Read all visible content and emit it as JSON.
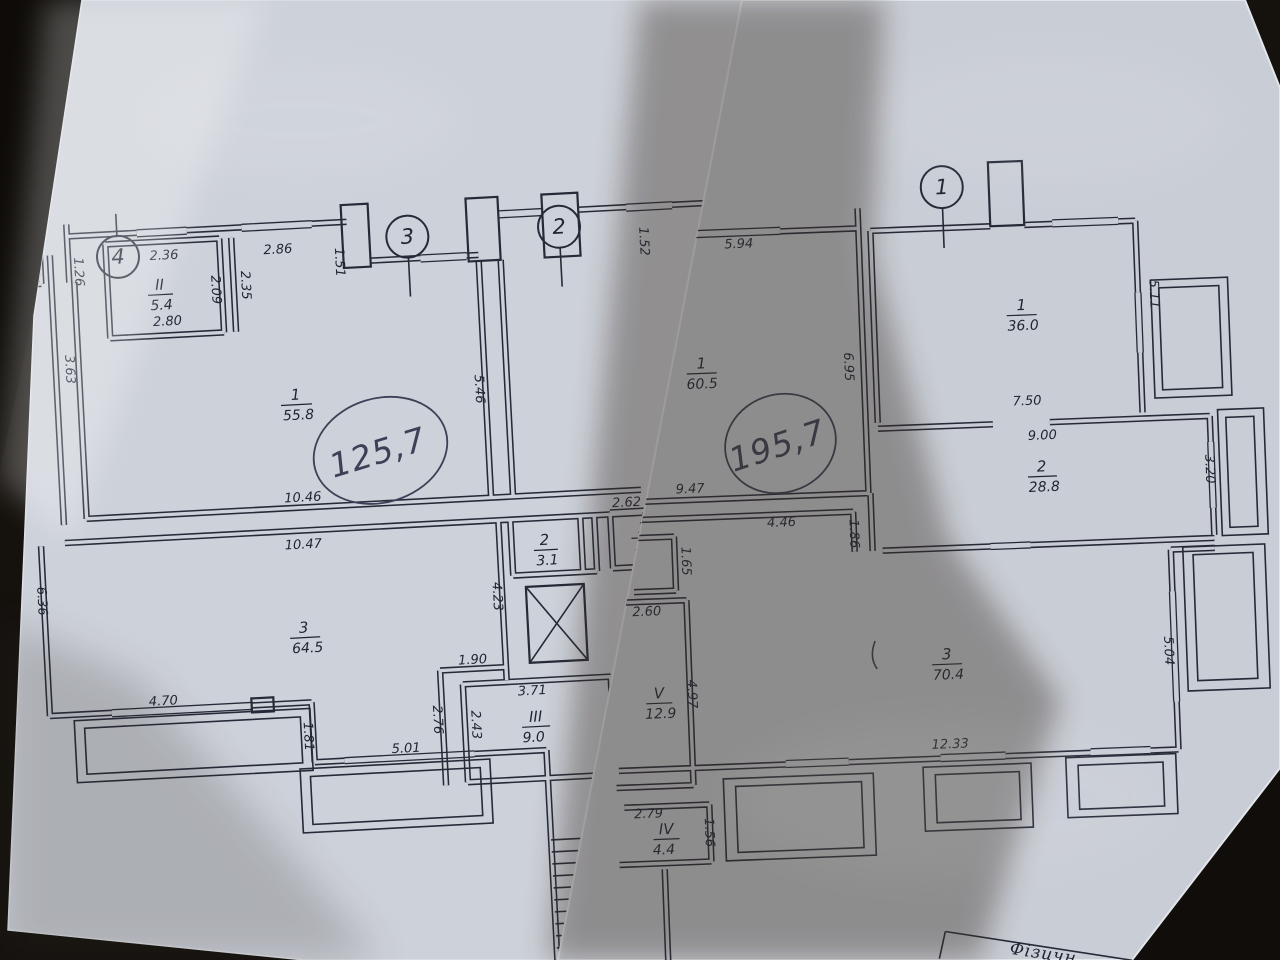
{
  "left_sheet": {
    "axis_markers": {
      "a4": "4",
      "a3": "3",
      "a2": "2"
    },
    "rooms": {
      "corner": {
        "num": "3",
        "area": "4.4"
      },
      "II": {
        "num": "II",
        "area": "5.4"
      },
      "r1": {
        "num": "1",
        "area": "55.8"
      },
      "r3": {
        "num": "3",
        "area": "64.5"
      },
      "r2a": {
        "num": "2",
        "area": "3.1"
      },
      "r2b": {
        "num": "2",
        "area": "4.3"
      },
      "rIII": {
        "num": "III",
        "area": "9.0"
      }
    },
    "dims": {
      "d346": "3.46",
      "d126": "1.26",
      "d236": "2.36",
      "d286": "2.86",
      "d151": "1.51",
      "d209": "2.09",
      "d235": "2.35",
      "d280": "2.80",
      "d363": "3.63",
      "d546": "5.46",
      "d152": "1.52",
      "d1046": "10.46",
      "d1047": "10.47",
      "d636": "6.36",
      "d423": "4.23",
      "d262": "2.62",
      "d190": "1.90",
      "d276": "2.76",
      "d243": "2.43",
      "d371": "3.71",
      "d470": "4.70",
      "d181": "1.81",
      "d501": "5.01"
    },
    "handwritten_total": "125,7"
  },
  "right_sheet": {
    "axis_markers": {
      "a1": "1"
    },
    "rooms": {
      "r1": {
        "num": "1",
        "area": "36.0"
      },
      "r1b": {
        "num": "1",
        "area": "60.5"
      },
      "r2": {
        "num": "2",
        "area": "28.8"
      },
      "r3": {
        "num": "3",
        "area": "70.4"
      },
      "rV": {
        "num": "V",
        "area": "12.9"
      },
      "rIV": {
        "num": "IV",
        "area": "4.4"
      }
    },
    "dims": {
      "d594": "5.94",
      "d511": "5.11",
      "d750": "7.50",
      "d900": "9.00",
      "d320": "3.20",
      "d695": "6.95",
      "d947": "9.47",
      "d446": "4.46",
      "d186": "1.86",
      "d1233": "12.33",
      "d504": "5.04",
      "d165": "1.65",
      "d260": "2.60",
      "d497": "4.97",
      "d279": "2.79",
      "d156": "1.56"
    },
    "handwritten_total": "195,7",
    "title_block_text": "Фізичн"
  }
}
